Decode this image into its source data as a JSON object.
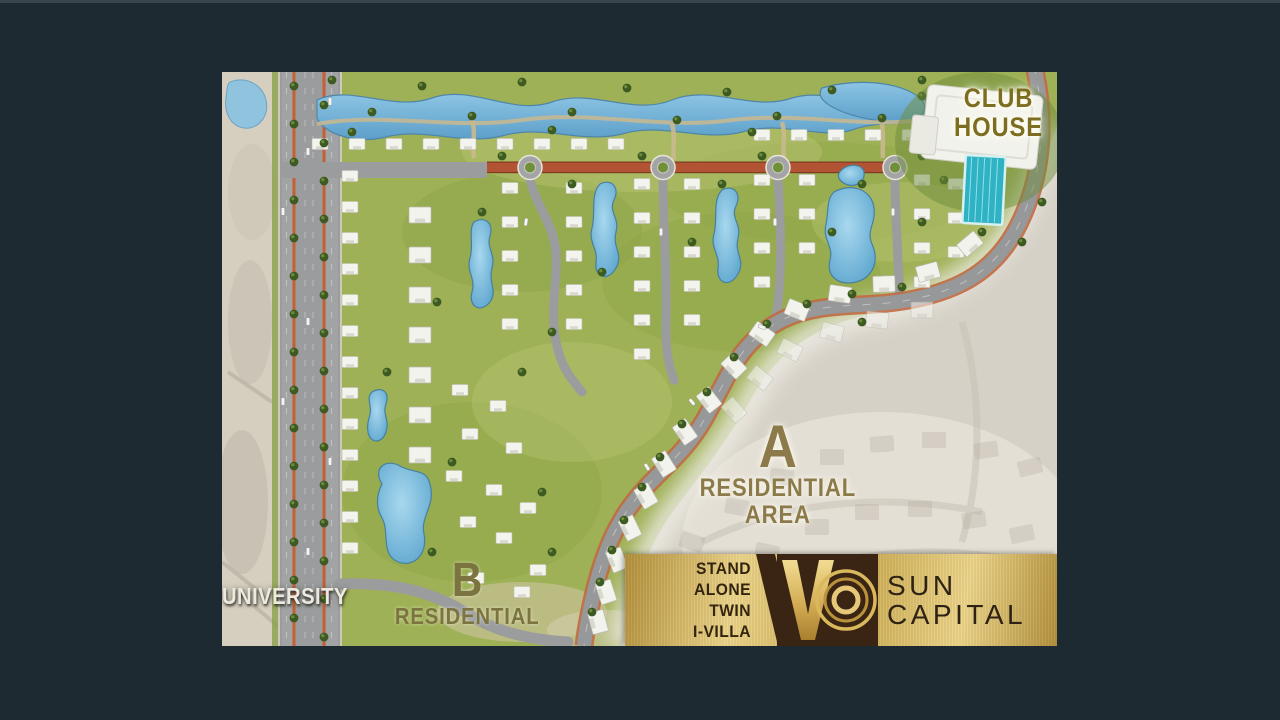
{
  "canvas": {
    "width": 1280,
    "height": 720
  },
  "colors": {
    "bg": "#1e2a31",
    "club_text": "#7c6d20",
    "area_a_text": "#8c7a4a",
    "area_b_text": "#7c7440",
    "university_text": "#ece9e2",
    "unit_text": "#33240f",
    "brand_text": "#2e2214",
    "gold_light": "#ecd489",
    "gold_mid": "#caa94f",
    "gold_dark": "#b3903c",
    "logo_brown": "#3a2413",
    "map_green": "#9fb156",
    "lagoon_blue": "#6fb4dc",
    "pool_teal": "#2fb3c4",
    "road_gray": "#97989a",
    "terracotta_road": "#b25434",
    "future_phase_gray": "#d6d1c7"
  },
  "map": {
    "labels": {
      "club_house": {
        "line1": "CLUB",
        "line2": "HOUSE"
      },
      "area_a": {
        "letter": "A",
        "line1": "RESIDENTIAL",
        "line2": "AREA"
      },
      "area_b": {
        "letter": "B",
        "line1": "RESIDENTIAL"
      },
      "university": {
        "text": "UNIVERSITY"
      }
    },
    "banner": {
      "unit_types": [
        "STAND ALONE",
        "TWIN",
        "I-VILLA"
      ],
      "logo": {
        "v": "V",
        "o": "O",
        "name": "VO"
      },
      "brand": {
        "line1": "SUN",
        "line2": "CAPITAL"
      }
    }
  }
}
